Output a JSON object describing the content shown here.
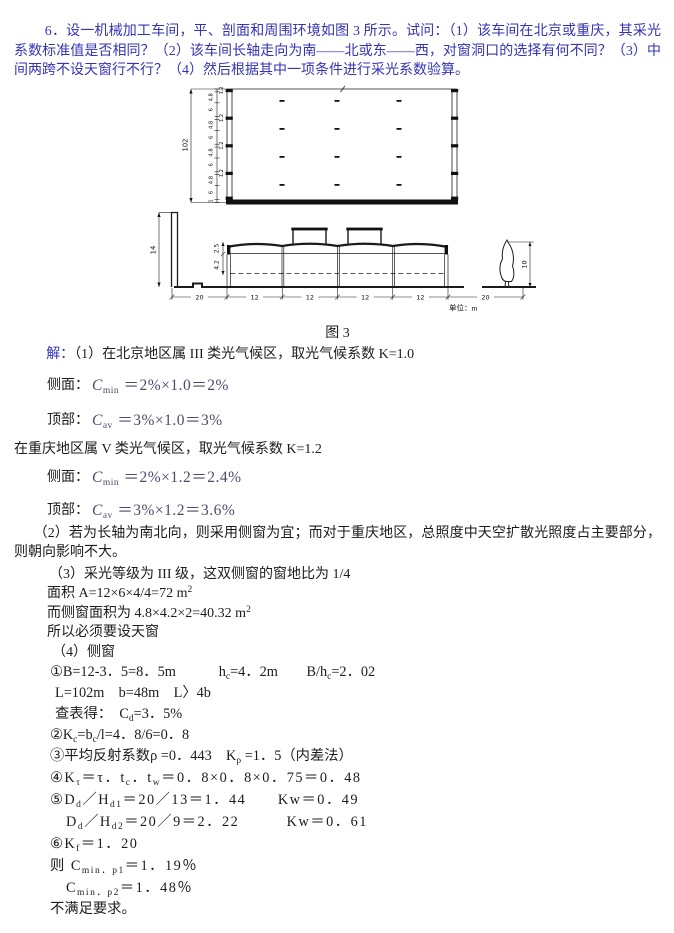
{
  "question": {
    "text": "6．设一机械加工车间，平、剖面和周围环境如图 3 所示。试问：（1）该车间在北京或重庆，其采光系数标准值是否相同？（2）该车间长轴走向为南——北或东——西，对窗洞口的选择有何不同？（3）中间两跨不设天窗行不行？（4）然后根据其中一项条件进行采光系数验算。",
    "color": "#3434b4"
  },
  "figure": {
    "caption": "图 3",
    "unit": "单位：m",
    "plan": {
      "total": "102",
      "segments": [
        "1.2",
        "4.8",
        "6",
        "1.2",
        "4.8",
        "6",
        "1.2",
        "4.8",
        "6",
        "1.2",
        "4.8",
        "6",
        "1"
      ]
    },
    "section": {
      "neighbor_height": "14",
      "upper_dim": "2.5",
      "window_dim": "4.2",
      "span_dims": [
        "20",
        "12",
        "12",
        "12",
        "12",
        "20"
      ],
      "tree_height": "10"
    }
  },
  "solution": {
    "label": "解：",
    "p1": "（1）在北京地区属 III 类光气候区，取光气候系数 K=1.0",
    "side1": {
      "label": "侧面：",
      "parts": [
        {
          "i": "C"
        },
        {
          "s": "min"
        },
        {
          "t": " ＝2%×1.0＝2%"
        }
      ]
    },
    "top1": {
      "label": "顶部：",
      "parts": [
        {
          "i": "C"
        },
        {
          "s": "av"
        },
        {
          "t": " ＝3%×1.0＝3%"
        }
      ]
    },
    "p1b": "在重庆地区属 V 类光气候区，取光气候系数 K=1.2",
    "side2": {
      "label": "侧面：",
      "parts": [
        {
          "i": "C"
        },
        {
          "s": "min"
        },
        {
          "t": " ＝2%×1.2＝2.4%"
        }
      ]
    },
    "top2": {
      "label": "顶部：",
      "parts": [
        {
          "i": "C"
        },
        {
          "s": "av"
        },
        {
          "t": " ＝3%×1.2＝3.6%"
        }
      ]
    },
    "p2": "（2）若为长轴为南北向，则采用侧窗为宜；而对于重庆地区，总照度中天空扩散光照度占主要部分，则朝向影响不大。",
    "p3": "（3）采光等级为 III 级，这双侧窗的窗地比为 1/4",
    "area": {
      "parts": [
        {
          "t": "面积 A=12×6×4/4=72 m"
        },
        {
          "p": "2"
        }
      ]
    },
    "side_area": {
      "parts": [
        {
          "t": "而侧窗面积为 4.8×4.2×2=40.32 m"
        },
        {
          "p": "2"
        }
      ]
    },
    "need": "所以必须要设天窗",
    "p4": "（4）侧窗",
    "s1": {
      "parts": [
        {
          "t": "①B=12-3．5=8．5m　　　h"
        },
        {
          "s": "c"
        },
        {
          "t": "=4．2m　　B/h"
        },
        {
          "s": "c"
        },
        {
          "t": "=2．02"
        }
      ]
    },
    "s1b": "L=102m　b=48m　L〉4b",
    "s1c": {
      "parts": [
        {
          "t": "查表得：　C"
        },
        {
          "s": "d"
        },
        {
          "t": "=3．5%"
        }
      ]
    },
    "s2": {
      "parts": [
        {
          "t": "②K"
        },
        {
          "s": "c"
        },
        {
          "t": "=b"
        },
        {
          "s": "c"
        },
        {
          "t": "/l=4．8/6=0．8"
        }
      ]
    },
    "s3": {
      "parts": [
        {
          "t": "③平均反射系数ρ =0．443　K"
        },
        {
          "s": "ρ"
        },
        {
          "t": " =1．5（内差法）"
        }
      ]
    },
    "s4": {
      "parts": [
        {
          "t": "④K"
        },
        {
          "s": "τ"
        },
        {
          "t": "＝τ．t"
        },
        {
          "s": "c"
        },
        {
          "t": "．t"
        },
        {
          "s": "w"
        },
        {
          "t": "＝0．8×0．8×0．75＝0．48"
        }
      ]
    },
    "s5a": {
      "parts": [
        {
          "t": "⑤D"
        },
        {
          "s": "d"
        },
        {
          "t": "／H"
        },
        {
          "s": "d1"
        },
        {
          "t": "＝20／13＝1．44　　Kw＝0．49"
        }
      ]
    },
    "s5b": {
      "parts": [
        {
          "t": "D"
        },
        {
          "s": "d"
        },
        {
          "t": "／H"
        },
        {
          "s": "d2"
        },
        {
          "t": "＝20／9＝2．22　　　Kw＝0．61"
        }
      ]
    },
    "s6": {
      "parts": [
        {
          "t": "⑥K"
        },
        {
          "s": "f"
        },
        {
          "t": "＝1．20"
        }
      ]
    },
    "r1": {
      "parts": [
        {
          "t": "则 C"
        },
        {
          "s": "min．p1"
        },
        {
          "t": "＝1．19％"
        }
      ]
    },
    "r2": {
      "parts": [
        {
          "t": "C"
        },
        {
          "s": "min．p2"
        },
        {
          "t": "＝1．48％"
        }
      ]
    },
    "end": "不满足要求。"
  }
}
